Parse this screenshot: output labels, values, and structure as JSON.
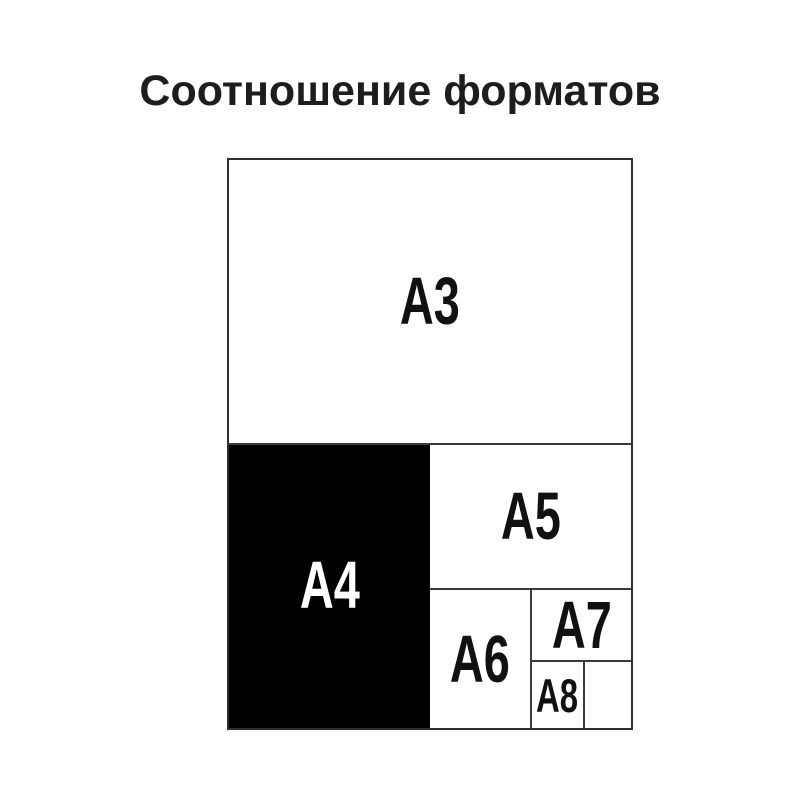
{
  "title": "Соотношение форматов",
  "diagram": {
    "description": "Nested rectangles showing relative sizes of ISO A-series paper formats",
    "border_color": "#2f2f2f",
    "line_color": "#3a3a3a",
    "background": "#ffffff",
    "highlight_fill": "#000000",
    "highlight_text_color": "#ffffff",
    "text_color": "#111111",
    "cells": [
      {
        "label": "A3",
        "fill": "#ffffff",
        "text_color": "#111111",
        "position": "top-half"
      },
      {
        "label": "A4",
        "fill": "#000000",
        "text_color": "#ffffff",
        "position": "bottom-left-quarter"
      },
      {
        "label": "A5",
        "fill": "#ffffff",
        "text_color": "#111111",
        "position": "right-of-A4-top"
      },
      {
        "label": "A6",
        "fill": "#ffffff",
        "text_color": "#111111",
        "position": "below-A5-left"
      },
      {
        "label": "A7",
        "fill": "#ffffff",
        "text_color": "#111111",
        "position": "below-A5-right-top"
      },
      {
        "label": "A8",
        "fill": "#ffffff",
        "text_color": "#111111",
        "position": "below-A7-left"
      },
      {
        "label": "",
        "fill": "#ffffff",
        "text_color": "#111111",
        "position": "below-A7-right-remainder"
      }
    ]
  }
}
